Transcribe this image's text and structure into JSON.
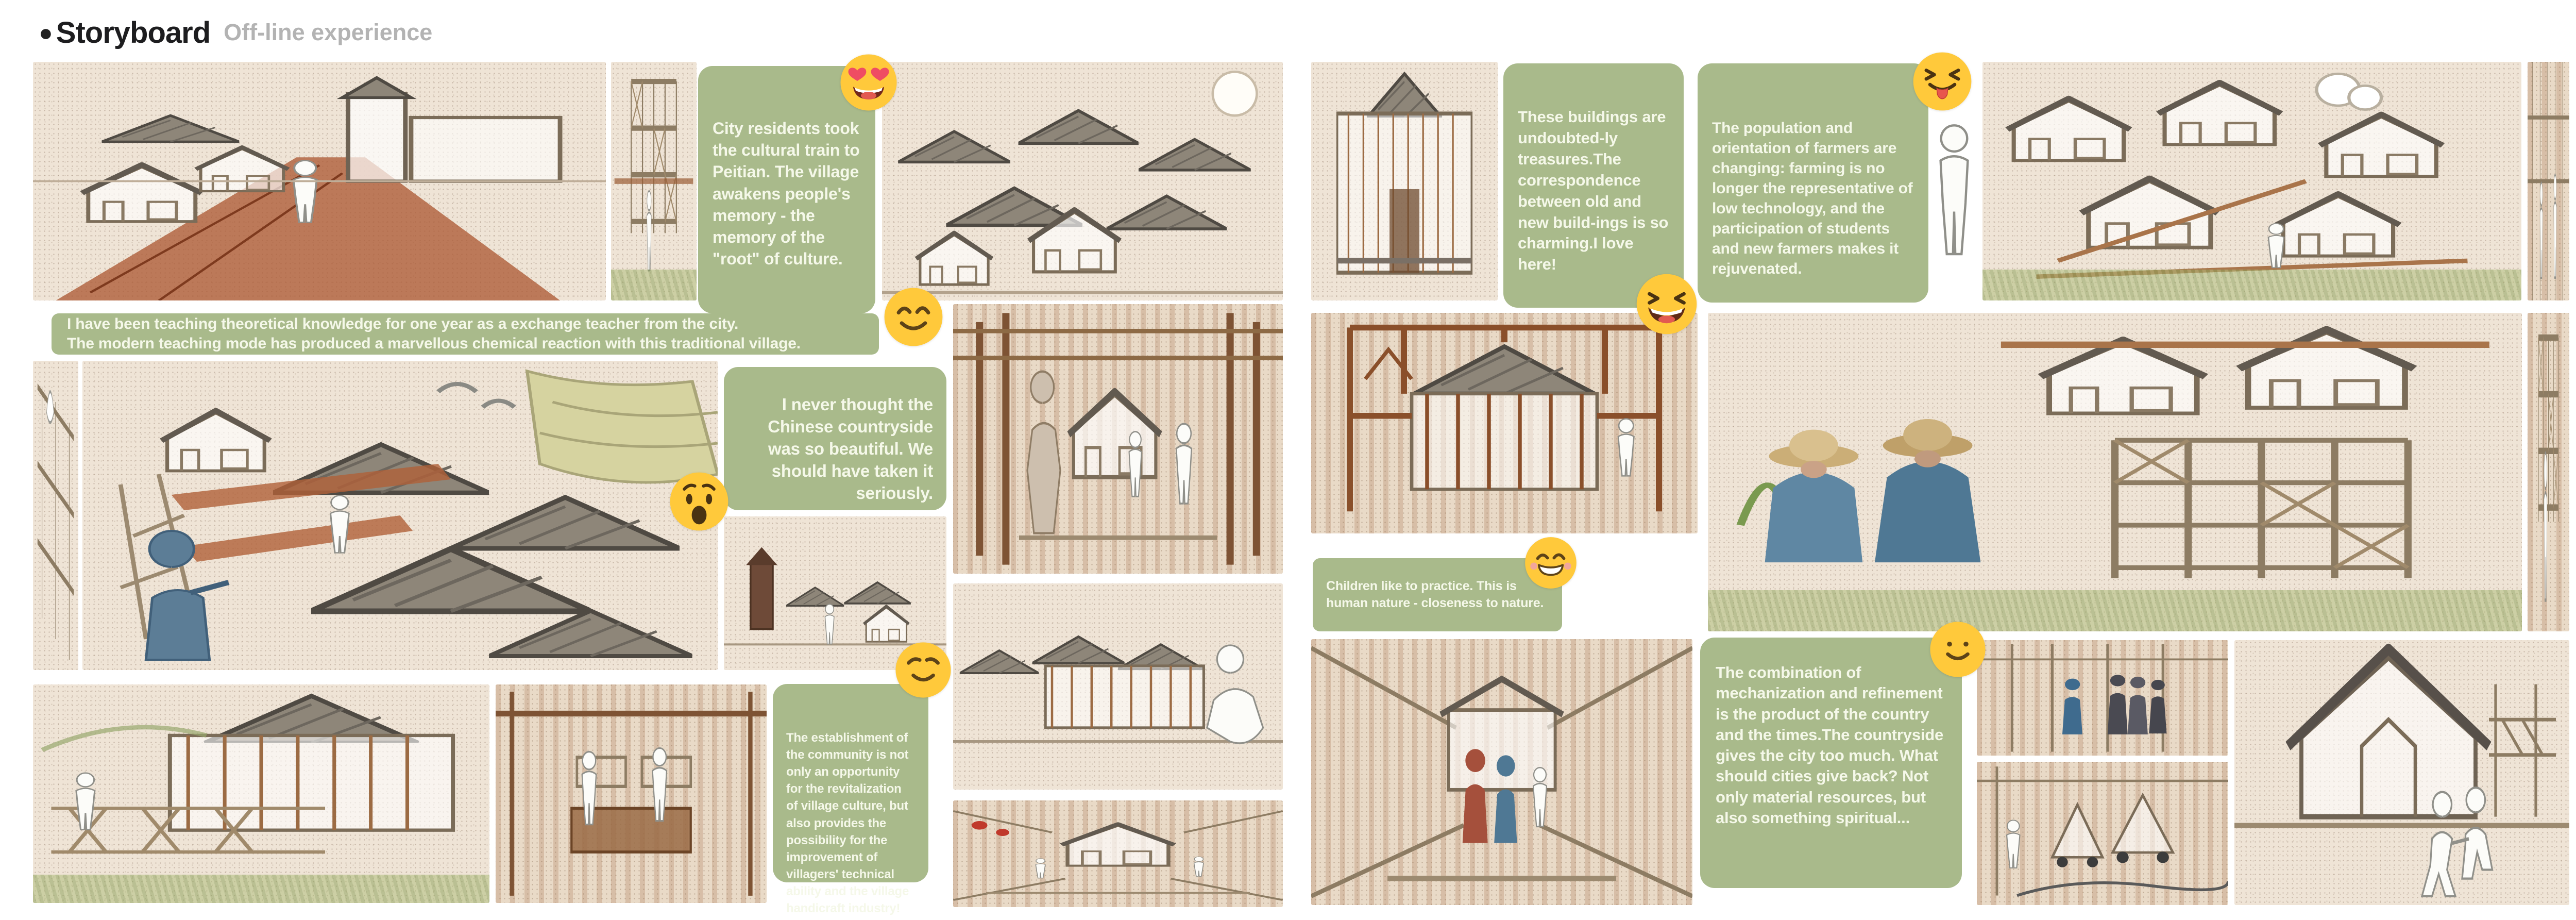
{
  "header": {
    "bullet": "●",
    "title": "Storyboard",
    "subtitle": "Off-line experience"
  },
  "colors": {
    "caption_bg": "#a9ba8b",
    "caption_text": "#f5f8e9",
    "emoji_yellow": "#ffc93b",
    "page_bg": "#ffffff",
    "sketch_paper": "#efe4d6",
    "brick": "#ad5b36",
    "roof_gray": "#8e8679",
    "grass_green": "#b0be7c"
  },
  "captions": {
    "box1": "City residents took the cultural train to Peitian. The village awakens people's memory - the memory of the \"root\" of culture.",
    "bar1_line1": "I have been teaching theoretical knowledge for one year as a exchange teacher from the city.",
    "bar1_line2": "The modern teaching mode has produced a marvellous chemical reaction with this traditional village.",
    "box2": "I never thought the Chinese countryside was so beautiful. We should have taken it seriously.",
    "box3": "The establishment of the community is not only an opportunity for the revitalization of village culture, but also provides the possibility for the improvement of villagers' technical ability and the village handicraft industry!",
    "box4": "These buildings are undoubted-ly treasures.The correspondence between old and new build-ings is so charming.I love here!",
    "box5": "The population and orientation of farmers are changing: farming is no longer the representative of low technology, and the participation of students and new farmers makes it rejuvenated.",
    "bar2_line1": "Children like to practice. This is",
    "bar2_line2": "human nature - closeness to nature.",
    "box6": "The combination of mechanization and refinement is the product of the country and the times.The countryside gives the city too much. What should cities give back? Not only material resources, but also something spiritual..."
  },
  "emojis": [
    {
      "name": "heart-eyes-emoji",
      "glyph": "😍"
    },
    {
      "name": "smiling-closed-eyes-emoji",
      "glyph": "😊"
    },
    {
      "name": "astonished-emoji",
      "glyph": "😲"
    },
    {
      "name": "relieved-smile-emoji",
      "glyph": "😌"
    },
    {
      "name": "laughing-squint-emoji",
      "glyph": "😆"
    },
    {
      "name": "squint-tongue-emoji",
      "glyph": "😝"
    },
    {
      "name": "grinning-emoji",
      "glyph": "😁"
    },
    {
      "name": "slight-smile-emoji",
      "glyph": "🙂"
    }
  ],
  "panels": [
    {
      "name": "panel-rail-village",
      "description": "Mobile tiny houses on a red rail track through the village, walking white figure, tower pavilion"
    },
    {
      "name": "panel-scaffold-tower",
      "description": "Timber scaffolding structure with white figure on green field"
    },
    {
      "name": "panel-aerial-old-village",
      "description": "Aerial sketch of the traditional village courtyards with a full moon"
    },
    {
      "name": "panel-truss-strip",
      "description": "Narrow strip of timber trusses with a white bird"
    },
    {
      "name": "panel-village-rooftops",
      "description": "Tiled rooftops with new walkways, terraced fields, birds and a man in blue pointing"
    },
    {
      "name": "panel-skyline-figure",
      "description": "Village skyline sketch with dark tower and white figure"
    },
    {
      "name": "panel-timber-corridor",
      "description": "Interior timber corridor with villager in a hat and white figures around a small house"
    },
    {
      "name": "panel-truss-walkway",
      "description": "Two-storey building with new timber truss walkway and a seated white figure"
    },
    {
      "name": "panel-craft-shop",
      "description": "Brick interior with two white figures at a wooden craft counter"
    },
    {
      "name": "panel-rooftop-panorama",
      "description": "Panorama of village rooftops with a crouching photographer figure"
    },
    {
      "name": "panel-courtyard",
      "description": "Symmetric courtyard with lattice-screen hall and small figures"
    },
    {
      "name": "panel-old-facade",
      "description": "Old timber house facade with stone base"
    },
    {
      "name": "panel-greenhouse-campus",
      "description": "Aerial sketch of new light-frame greenhouse buildings, sketched cloud, white figure"
    },
    {
      "name": "panel-glass-tower",
      "description": "Narrow vertical sketch of two figures talking in a tall framed space"
    },
    {
      "name": "panel-frame-hall",
      "description": "Traditional hall wrapped in a new timber frame with standing white figure"
    },
    {
      "name": "panel-farmers-structures",
      "description": "Two smiling farmers in straw hats among plants in front of new timber-frame buildings"
    },
    {
      "name": "panel-lattice-strip",
      "description": "Narrow lattice structure sketch with sitting white figure"
    },
    {
      "name": "panel-street-scene",
      "description": "Village street with colored figures walking between brick buildings"
    },
    {
      "name": "panel-visitors-group",
      "description": "Group of visitors walking through a timber frame interior"
    },
    {
      "name": "panel-workshop-carts",
      "description": "Workshop with small wheeled timber house frames and a white figure"
    },
    {
      "name": "panel-house-children",
      "description": "New gabled house sketch with two white children running hand in hand"
    }
  ]
}
